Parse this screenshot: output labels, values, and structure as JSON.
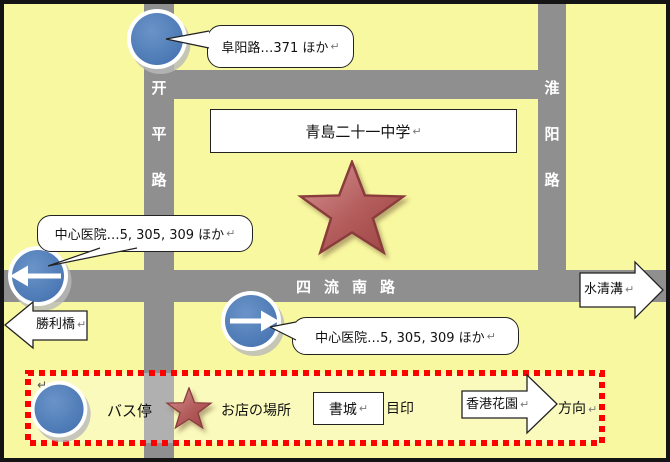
{
  "map": {
    "school": "青島二十一中学",
    "roads": {
      "kaiping": [
        "开",
        "平",
        "路"
      ],
      "huaiyang": [
        "淮",
        "阳",
        "路"
      ],
      "siliu": [
        "四",
        "流",
        "南",
        "路"
      ]
    },
    "callouts": {
      "fuyang": "阜阳路…371 ほか",
      "hospital_left": "中心医院…5, 305, 309 ほか",
      "hospital_mid": "中心医院…5, 305, 309 ほか"
    },
    "edge_arrows": {
      "shengliqiao": "勝利橋",
      "shuiqinggou": "水清溝"
    }
  },
  "legend": {
    "bus_stop": "バス停",
    "shop": "お店の場所",
    "landmark_box": "書城",
    "landmark": "目印",
    "direction_box": "香港花園",
    "direction": "方向"
  },
  "marks": {
    "return_mark": "↵"
  },
  "colors": {
    "map_yellow": "#f8f8a0",
    "road_gray": "#8f8f8f",
    "bus_blue": "#4b7ab6",
    "star_red": "#b35c5c",
    "legend_dot_red": "#fb0200",
    "shape_white": "#ffffff"
  }
}
